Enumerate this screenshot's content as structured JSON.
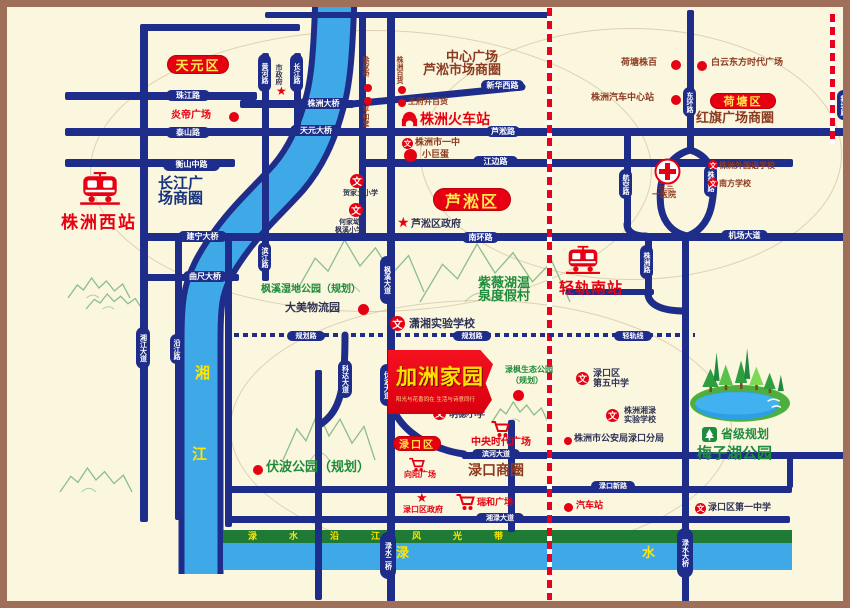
{
  "banner": {
    "title": "加洲家园",
    "subtitle": "阳光与花香同在 生活与诗意同行"
  },
  "colors": {
    "red": "#E60012",
    "maroon": "#8C3A20",
    "navy": "#2F3355",
    "green": "#1E8C3C",
    "blue": "#16327F",
    "yellow": "#FFE600",
    "road": "#1F2D8A",
    "river": "#3FA9E8",
    "greenbelt": "#1E7A34",
    "bg": "#FBF6DE",
    "frame": "#9F6F59"
  },
  "icon_glyphs": {
    "school": "文",
    "star": "★"
  },
  "districts": [
    {
      "name": "tianyuan-district",
      "label": "天元区",
      "x": 167,
      "y": 55,
      "w": 62,
      "h": 19,
      "fs": 13
    },
    {
      "name": "hetang-district",
      "label": "荷塘区",
      "x": 710,
      "y": 93,
      "w": 66,
      "h": 16,
      "fs": 11
    },
    {
      "name": "lusong-district",
      "label": "芦淞区",
      "x": 433,
      "y": 188,
      "w": 78,
      "h": 23,
      "fs": 16
    },
    {
      "name": "lukou-district",
      "label": "渌口区",
      "x": 393,
      "y": 436,
      "w": 48,
      "h": 15,
      "fs": 10
    }
  ],
  "road_pills": [
    {
      "name": "zhujiang-road-pill",
      "label": "珠江路",
      "x": 166,
      "y": 90,
      "w": 44,
      "h": 11,
      "fs": 8
    },
    {
      "name": "taishan-road-pill",
      "label": "泰山路",
      "x": 166,
      "y": 127,
      "w": 44,
      "h": 11,
      "fs": 8
    },
    {
      "name": "hengshan-mid-road-pill",
      "label": "衡山中路",
      "x": 163,
      "y": 159,
      "w": 57,
      "h": 12,
      "fs": 8
    },
    {
      "name": "huanghe-road-pill",
      "label": "黄河路",
      "x": 258,
      "y": 54,
      "w": 13,
      "h": 38,
      "v": 1,
      "fs": 7
    },
    {
      "name": "changjiang-road-pill",
      "label": "长江路",
      "x": 290,
      "y": 54,
      "w": 13,
      "h": 38,
      "v": 1,
      "fs": 7
    },
    {
      "name": "zhuzhou-bridge-pill",
      "label": "株洲大桥",
      "x": 299,
      "y": 98,
      "w": 49,
      "h": 11,
      "fs": 8
    },
    {
      "name": "tianyuan-bridge-pill",
      "label": "天元大桥",
      "x": 290,
      "y": 125,
      "w": 52,
      "h": 11,
      "fs": 8
    },
    {
      "name": "xinhua-west-road-pill",
      "label": "新华西路",
      "x": 481,
      "y": 80,
      "w": 43,
      "h": 11,
      "fs": 8
    },
    {
      "name": "lusong-road-pill",
      "label": "芦淞路",
      "x": 486,
      "y": 126,
      "w": 34,
      "h": 11,
      "fs": 8
    },
    {
      "name": "jiangbian-road-pill",
      "label": "江边路",
      "x": 473,
      "y": 156,
      "w": 45,
      "h": 11,
      "fs": 8
    },
    {
      "name": "donghuan-road-pill",
      "label": "东环路",
      "x": 683,
      "y": 87,
      "w": 13,
      "h": 30,
      "v": 1,
      "fs": 7
    },
    {
      "name": "xintang-road-pill",
      "label": "新塘路",
      "x": 837,
      "y": 90,
      "w": 13,
      "h": 30,
      "v": 1,
      "fs": 7
    },
    {
      "name": "jianning-bridge-pill",
      "label": "建宁大桥",
      "x": 178,
      "y": 231,
      "w": 49,
      "h": 11,
      "fs": 8
    },
    {
      "name": "quchi-bridge-pill",
      "label": "曲尺大桥",
      "x": 183,
      "y": 271,
      "w": 44,
      "h": 11,
      "fs": 8
    },
    {
      "name": "nanhuan-road-pill",
      "label": "南环路",
      "x": 462,
      "y": 232,
      "w": 37,
      "h": 11,
      "fs": 8
    },
    {
      "name": "jichang-avenue-pill",
      "label": "机场大道",
      "x": 721,
      "y": 230,
      "w": 47,
      "h": 11,
      "fs": 8
    },
    {
      "name": "binjiang-road-pill",
      "label": "滨江路",
      "x": 258,
      "y": 242,
      "w": 13,
      "h": 30,
      "v": 1,
      "fs": 7
    },
    {
      "name": "yanjiang-road-pill",
      "label": "沿江路",
      "x": 170,
      "y": 334,
      "w": 13,
      "h": 30,
      "v": 1,
      "fs": 7
    },
    {
      "name": "xiangjiang-avenue-pill",
      "label": "湘江大道",
      "x": 136,
      "y": 327,
      "w": 14,
      "h": 42,
      "v": 1,
      "fs": 7
    },
    {
      "name": "fengxi-avenue-pill",
      "label": "枫溪大道",
      "x": 380,
      "y": 256,
      "w": 14,
      "h": 48,
      "v": 1,
      "fs": 7
    },
    {
      "name": "fubo-avenue-pill",
      "label": "伏波大道",
      "x": 380,
      "y": 364,
      "w": 14,
      "h": 42,
      "v": 1,
      "fs": 7
    },
    {
      "name": "keda-avenue-pill",
      "label": "科达大道",
      "x": 338,
      "y": 360,
      "w": 14,
      "h": 38,
      "v": 1,
      "fs": 7
    },
    {
      "name": "hangkong-road-pill",
      "label": "航空路",
      "x": 619,
      "y": 169,
      "w": 13,
      "h": 30,
      "v": 1,
      "fs": 7
    },
    {
      "name": "zhudong-road-pill",
      "label": "株董路",
      "x": 704,
      "y": 165,
      "w": 13,
      "h": 32,
      "v": 1,
      "fs": 7
    },
    {
      "name": "zhuzhou-road-pill",
      "label": "株洲路",
      "x": 640,
      "y": 245,
      "w": 13,
      "h": 34,
      "v": 1,
      "fs": 7
    },
    {
      "name": "planned-road-pill-1",
      "label": "规划路",
      "x": 287,
      "y": 331,
      "w": 38,
      "h": 10,
      "fs": 7
    },
    {
      "name": "planned-road-pill-2",
      "label": "规划路",
      "x": 453,
      "y": 331,
      "w": 38,
      "h": 10,
      "fs": 7
    },
    {
      "name": "light-rail-line-pill",
      "label": "轻轨线",
      "x": 614,
      "y": 331,
      "w": 38,
      "h": 10,
      "fs": 7
    },
    {
      "name": "binhe-avenue-pill",
      "label": "滨河大道",
      "x": 472,
      "y": 449,
      "w": 48,
      "h": 10,
      "fs": 7
    },
    {
      "name": "xianglu-avenue-pill",
      "label": "湘渌大道",
      "x": 476,
      "y": 513,
      "w": 48,
      "h": 10,
      "fs": 7
    },
    {
      "name": "lukou-new-road-pill",
      "label": "渌口新路",
      "x": 591,
      "y": 481,
      "w": 44,
      "h": 10,
      "fs": 7
    },
    {
      "name": "lushui-2nd-bridge-pill",
      "label": "渌水二桥",
      "x": 380,
      "y": 532,
      "w": 16,
      "h": 47,
      "v": 1,
      "fs": 7
    },
    {
      "name": "lushui-bridge-pill",
      "label": "渌水大桥",
      "x": 677,
      "y": 528,
      "w": 16,
      "h": 50,
      "v": 1,
      "fs": 7
    }
  ],
  "labels": [
    {
      "name": "center-plaza",
      "text": "中心广场",
      "x": 446,
      "y": 51,
      "fs": 13,
      "c": "maroon"
    },
    {
      "name": "lusong-market-cbd",
      "text": "芦淞市场商圈",
      "x": 423,
      "y": 64,
      "fs": 13,
      "c": "maroon"
    },
    {
      "name": "hongqi-plaza-cbd",
      "text": "红旗广场商圈",
      "x": 696,
      "y": 112,
      "fs": 13,
      "c": "maroon"
    },
    {
      "name": "changjiang-cbd-line1",
      "text": "长江广",
      "x": 158,
      "y": 175,
      "fs": 15,
      "c": "blue"
    },
    {
      "name": "changjiang-cbd-line2",
      "text": "场商圈",
      "x": 158,
      "y": 190,
      "fs": 15,
      "c": "blue"
    },
    {
      "name": "lukou-cbd",
      "text": "渌口商圈",
      "x": 468,
      "y": 463,
      "fs": 14,
      "c": "maroon"
    },
    {
      "name": "zhuzhou-west-station",
      "text": "株洲西站",
      "x": 61,
      "y": 214,
      "fs": 17,
      "c": "red",
      "ls": 2
    },
    {
      "name": "zhuzhou-railway-station",
      "text": "株洲火车站",
      "x": 420,
      "y": 112,
      "fs": 14,
      "c": "red"
    },
    {
      "name": "light-rail-south-station",
      "text": "轻轨南站",
      "x": 559,
      "y": 280,
      "fs": 15,
      "c": "red",
      "ls": 1
    },
    {
      "name": "yandi-plaza",
      "text": "炎帝广场",
      "x": 171,
      "y": 110,
      "fs": 10,
      "c": "red"
    },
    {
      "name": "wangfujing-store",
      "text": "王府井百货",
      "x": 408,
      "y": 97,
      "fs": 8,
      "c": "maroon"
    },
    {
      "name": "no1-middle-school",
      "text": "株洲市一中",
      "x": 415,
      "y": 138,
      "fs": 9,
      "c": "maroon"
    },
    {
      "name": "little-dome",
      "text": "小巨蛋",
      "x": 422,
      "y": 150,
      "fs": 9,
      "c": "maroon"
    },
    {
      "name": "xujiaqiao",
      "text": "徐家桥",
      "x": 362,
      "y": 56,
      "fs": 7,
      "c": "maroon",
      "v": 1
    },
    {
      "name": "pinghetang",
      "text": "平和堂",
      "x": 362,
      "y": 106,
      "fs": 7,
      "c": "maroon",
      "v": 1
    },
    {
      "name": "zhuzhou-dept-store",
      "text": "株洲百货",
      "x": 396,
      "y": 56,
      "fs": 7,
      "c": "maroon",
      "v": 1
    },
    {
      "name": "hetang-zhubai",
      "text": "荷塘株百",
      "x": 621,
      "y": 58,
      "fs": 9,
      "c": "maroon"
    },
    {
      "name": "baiyun-times-plaza",
      "text": "白云东方时代广场",
      "x": 711,
      "y": 58,
      "fs": 9,
      "c": "maroon"
    },
    {
      "name": "auto-center-station",
      "text": "株洲汽车中心站",
      "x": 591,
      "y": 93,
      "fs": 9,
      "c": "maroon"
    },
    {
      "name": "foreign-language-school",
      "text": "株洲外国语学校",
      "x": 719,
      "y": 161,
      "fs": 8,
      "c": "maroon"
    },
    {
      "name": "nanfang-school",
      "text": "南方学校",
      "x": 719,
      "y": 179,
      "fs": 8,
      "c": "maroon"
    },
    {
      "name": "hospital-331-line1",
      "text": "三三",
      "x": 658,
      "y": 182,
      "fs": 8,
      "c": "maroon"
    },
    {
      "name": "hospital-331-line2",
      "text": "一医院",
      "x": 652,
      "y": 190,
      "fs": 8,
      "c": "maroon"
    },
    {
      "name": "hejiatu-primary",
      "text": "贺家土小学",
      "x": 343,
      "y": 189,
      "fs": 7,
      "c": "navy"
    },
    {
      "name": "hejiaao-line1",
      "text": "何家坳",
      "x": 339,
      "y": 218,
      "fs": 7,
      "c": "navy"
    },
    {
      "name": "hejiaao-line2",
      "text": "枫溪小学",
      "x": 335,
      "y": 226,
      "fs": 7,
      "c": "navy"
    },
    {
      "name": "lusong-gov",
      "text": "芦淞区政府",
      "x": 411,
      "y": 219,
      "fs": 10,
      "c": "navy"
    },
    {
      "name": "fengxi-wetland-park",
      "text": "枫溪湿地公园（规划）",
      "x": 261,
      "y": 284,
      "fs": 10,
      "c": "green"
    },
    {
      "name": "damei-logistics-park",
      "text": "大美物流园",
      "x": 285,
      "y": 302,
      "fs": 11,
      "c": "navy"
    },
    {
      "name": "ziwei-lake-line1",
      "text": "紫薇湖温",
      "x": 478,
      "y": 277,
      "fs": 13,
      "c": "green"
    },
    {
      "name": "ziwei-lake-line2",
      "text": "泉度假村",
      "x": 478,
      "y": 290,
      "fs": 13,
      "c": "green"
    },
    {
      "name": "xiaoxiang-school",
      "text": "潇湘实验学校",
      "x": 409,
      "y": 318,
      "fs": 11,
      "c": "navy"
    },
    {
      "name": "lufeng-park-line1",
      "text": "渌枫生态公园",
      "x": 505,
      "y": 365,
      "fs": 8,
      "c": "green"
    },
    {
      "name": "lufeng-park-line2",
      "text": "（规划）",
      "x": 511,
      "y": 376,
      "fs": 8,
      "c": "green"
    },
    {
      "name": "lukou-5th-school-line1",
      "text": "渌口区",
      "x": 593,
      "y": 369,
      "fs": 9,
      "c": "navy"
    },
    {
      "name": "lukou-5th-school-line2",
      "text": "第五中学",
      "x": 593,
      "y": 379,
      "fs": 9,
      "c": "navy"
    },
    {
      "name": "mingde-primary",
      "text": "明德小学",
      "x": 449,
      "y": 410,
      "fs": 9,
      "c": "navy"
    },
    {
      "name": "central-times-plaza",
      "text": "中央时代广场",
      "x": 471,
      "y": 437,
      "fs": 10,
      "c": "red"
    },
    {
      "name": "xiangyang-plaza",
      "text": "向阳广场",
      "x": 404,
      "y": 470,
      "fs": 8,
      "c": "red"
    },
    {
      "name": "lukou-gov",
      "text": "渌口区政府",
      "x": 403,
      "y": 505,
      "fs": 8,
      "c": "red"
    },
    {
      "name": "ruihe-plaza",
      "text": "瑞和广场",
      "x": 477,
      "y": 498,
      "fs": 9,
      "c": "red"
    },
    {
      "name": "bus-station",
      "text": "汽车站",
      "x": 576,
      "y": 501,
      "fs": 9,
      "c": "red"
    },
    {
      "name": "lukou-no1-school",
      "text": "渌口区第一中学",
      "x": 708,
      "y": 503,
      "fs": 9,
      "c": "navy"
    },
    {
      "name": "xianglu-school-line1",
      "text": "株洲湘渌",
      "x": 624,
      "y": 406,
      "fs": 8,
      "c": "navy"
    },
    {
      "name": "xianglu-school-line2",
      "text": "实验学校",
      "x": 624,
      "y": 415,
      "fs": 8,
      "c": "navy"
    },
    {
      "name": "lukou-police",
      "text": "株洲市公安局渌口分局",
      "x": 574,
      "y": 434,
      "fs": 9,
      "c": "navy"
    },
    {
      "name": "fubo-park",
      "text": "伏波公园（规划）",
      "x": 266,
      "y": 461,
      "fs": 13,
      "c": "green"
    },
    {
      "name": "provincial-plan",
      "text": "省级规划",
      "x": 721,
      "y": 428,
      "fs": 12,
      "c": "green"
    },
    {
      "name": "meizihu-park",
      "text": "梅子湖公园",
      "x": 697,
      "y": 445,
      "fs": 15,
      "c": "green"
    },
    {
      "name": "xiangjiang-char1",
      "text": "湘",
      "x": 195,
      "y": 365,
      "fs": 15,
      "c": "yellow"
    },
    {
      "name": "xiangjiang-char2",
      "text": "江",
      "x": 192,
      "y": 446,
      "fs": 15,
      "c": "yellow"
    },
    {
      "name": "lushui-char1",
      "text": "渌",
      "x": 396,
      "y": 547,
      "fs": 13,
      "c": "yellow"
    },
    {
      "name": "lushui-char2",
      "text": "水",
      "x": 642,
      "y": 547,
      "fs": 13,
      "c": "yellow"
    },
    {
      "name": "greenbelt-label",
      "text": "渌水沿江风光带",
      "x": 248,
      "y": 532,
      "fs": 9,
      "c": "yellow",
      "ls": 32
    },
    {
      "name": "city-gov",
      "text": "市政府",
      "x": 275,
      "y": 64,
      "fs": 7,
      "c": "navy",
      "v": 1
    }
  ],
  "icons": [
    {
      "name": "west-station-train-icon",
      "type": "train",
      "x": 79,
      "y": 171,
      "s": 42
    },
    {
      "name": "railway-station-icon",
      "type": "station",
      "x": 400,
      "y": 110,
      "s": 19
    },
    {
      "name": "lightrail-station-train-icon",
      "type": "train",
      "x": 565,
      "y": 245,
      "s": 36
    },
    {
      "name": "no1-middle-school-icon",
      "type": "school",
      "x": 402,
      "y": 138,
      "s": 11
    },
    {
      "name": "hejiatu-school-icon",
      "type": "school",
      "x": 350,
      "y": 174,
      "s": 14
    },
    {
      "name": "hejiaao-school-icon",
      "type": "school",
      "x": 349,
      "y": 203,
      "s": 14
    },
    {
      "name": "xiaoxiang-school-icon",
      "type": "school",
      "x": 390,
      "y": 316,
      "s": 15
    },
    {
      "name": "mingde-school-icon",
      "type": "school",
      "x": 433,
      "y": 407,
      "s": 13
    },
    {
      "name": "lukou-5th-school-icon",
      "type": "school",
      "x": 576,
      "y": 372,
      "s": 13
    },
    {
      "name": "xianglu-school-icon",
      "type": "school",
      "x": 606,
      "y": 409,
      "s": 13
    },
    {
      "name": "lukou-no1-school-icon",
      "type": "school",
      "x": 695,
      "y": 503,
      "s": 11
    },
    {
      "name": "foreign-school-icon",
      "type": "school",
      "x": 708,
      "y": 160,
      "s": 10
    },
    {
      "name": "nanfang-school-icon",
      "type": "school",
      "x": 708,
      "y": 178,
      "s": 10
    },
    {
      "name": "city-gov-star-icon",
      "type": "star",
      "x": 276,
      "y": 85,
      "s": 12
    },
    {
      "name": "lusong-gov-star-icon",
      "type": "star",
      "x": 397,
      "y": 216,
      "s": 14
    },
    {
      "name": "lukou-gov-star-icon",
      "type": "star",
      "x": 416,
      "y": 492,
      "s": 13
    },
    {
      "name": "hospital-331-cross-icon",
      "type": "cross",
      "x": 654,
      "y": 158,
      "s": 27
    },
    {
      "name": "central-plaza-cart-icon",
      "type": "cart",
      "x": 490,
      "y": 420,
      "s": 20
    },
    {
      "name": "xiangyang-cart-icon",
      "type": "cart",
      "x": 408,
      "y": 457,
      "s": 17
    },
    {
      "name": "ruihe-cart-icon",
      "type": "cart",
      "x": 455,
      "y": 493,
      "s": 20
    },
    {
      "name": "park-plan-icon",
      "type": "park",
      "x": 702,
      "y": 427,
      "s": 15
    },
    {
      "name": "meizihu-lake-art",
      "type": "lake",
      "x": 688,
      "y": 334,
      "s": 102
    },
    {
      "name": "yandi-dot",
      "type": "dot",
      "x": 229,
      "y": 112,
      "s": 10
    },
    {
      "name": "xujiaqiao-dot",
      "type": "dot",
      "x": 364,
      "y": 84,
      "s": 8
    },
    {
      "name": "pinghetang-dot",
      "type": "dot",
      "x": 364,
      "y": 97,
      "s": 8
    },
    {
      "name": "zhubaihuo-dot",
      "type": "dot",
      "x": 398,
      "y": 86,
      "s": 8
    },
    {
      "name": "wangfujing-dot",
      "type": "dot",
      "x": 398,
      "y": 99,
      "s": 8
    },
    {
      "name": "hetang-zhubai-dot",
      "type": "dot",
      "x": 671,
      "y": 60,
      "s": 10
    },
    {
      "name": "baiyun-dot",
      "type": "dot",
      "x": 697,
      "y": 61,
      "s": 10
    },
    {
      "name": "auto-center-dot",
      "type": "dot",
      "x": 671,
      "y": 95,
      "s": 10
    },
    {
      "name": "little-dome-dot",
      "type": "dot",
      "x": 404,
      "y": 149,
      "s": 13
    },
    {
      "name": "damei-dot",
      "type": "dot",
      "x": 358,
      "y": 304,
      "s": 11
    },
    {
      "name": "lufeng-dot",
      "type": "dot",
      "x": 513,
      "y": 390,
      "s": 11
    },
    {
      "name": "fubo-dot",
      "type": "dot",
      "x": 253,
      "y": 465,
      "s": 10
    },
    {
      "name": "police-dot",
      "type": "dot",
      "x": 564,
      "y": 437,
      "s": 8
    },
    {
      "name": "bus-station-dot",
      "type": "dot",
      "x": 564,
      "y": 503,
      "s": 9
    }
  ]
}
